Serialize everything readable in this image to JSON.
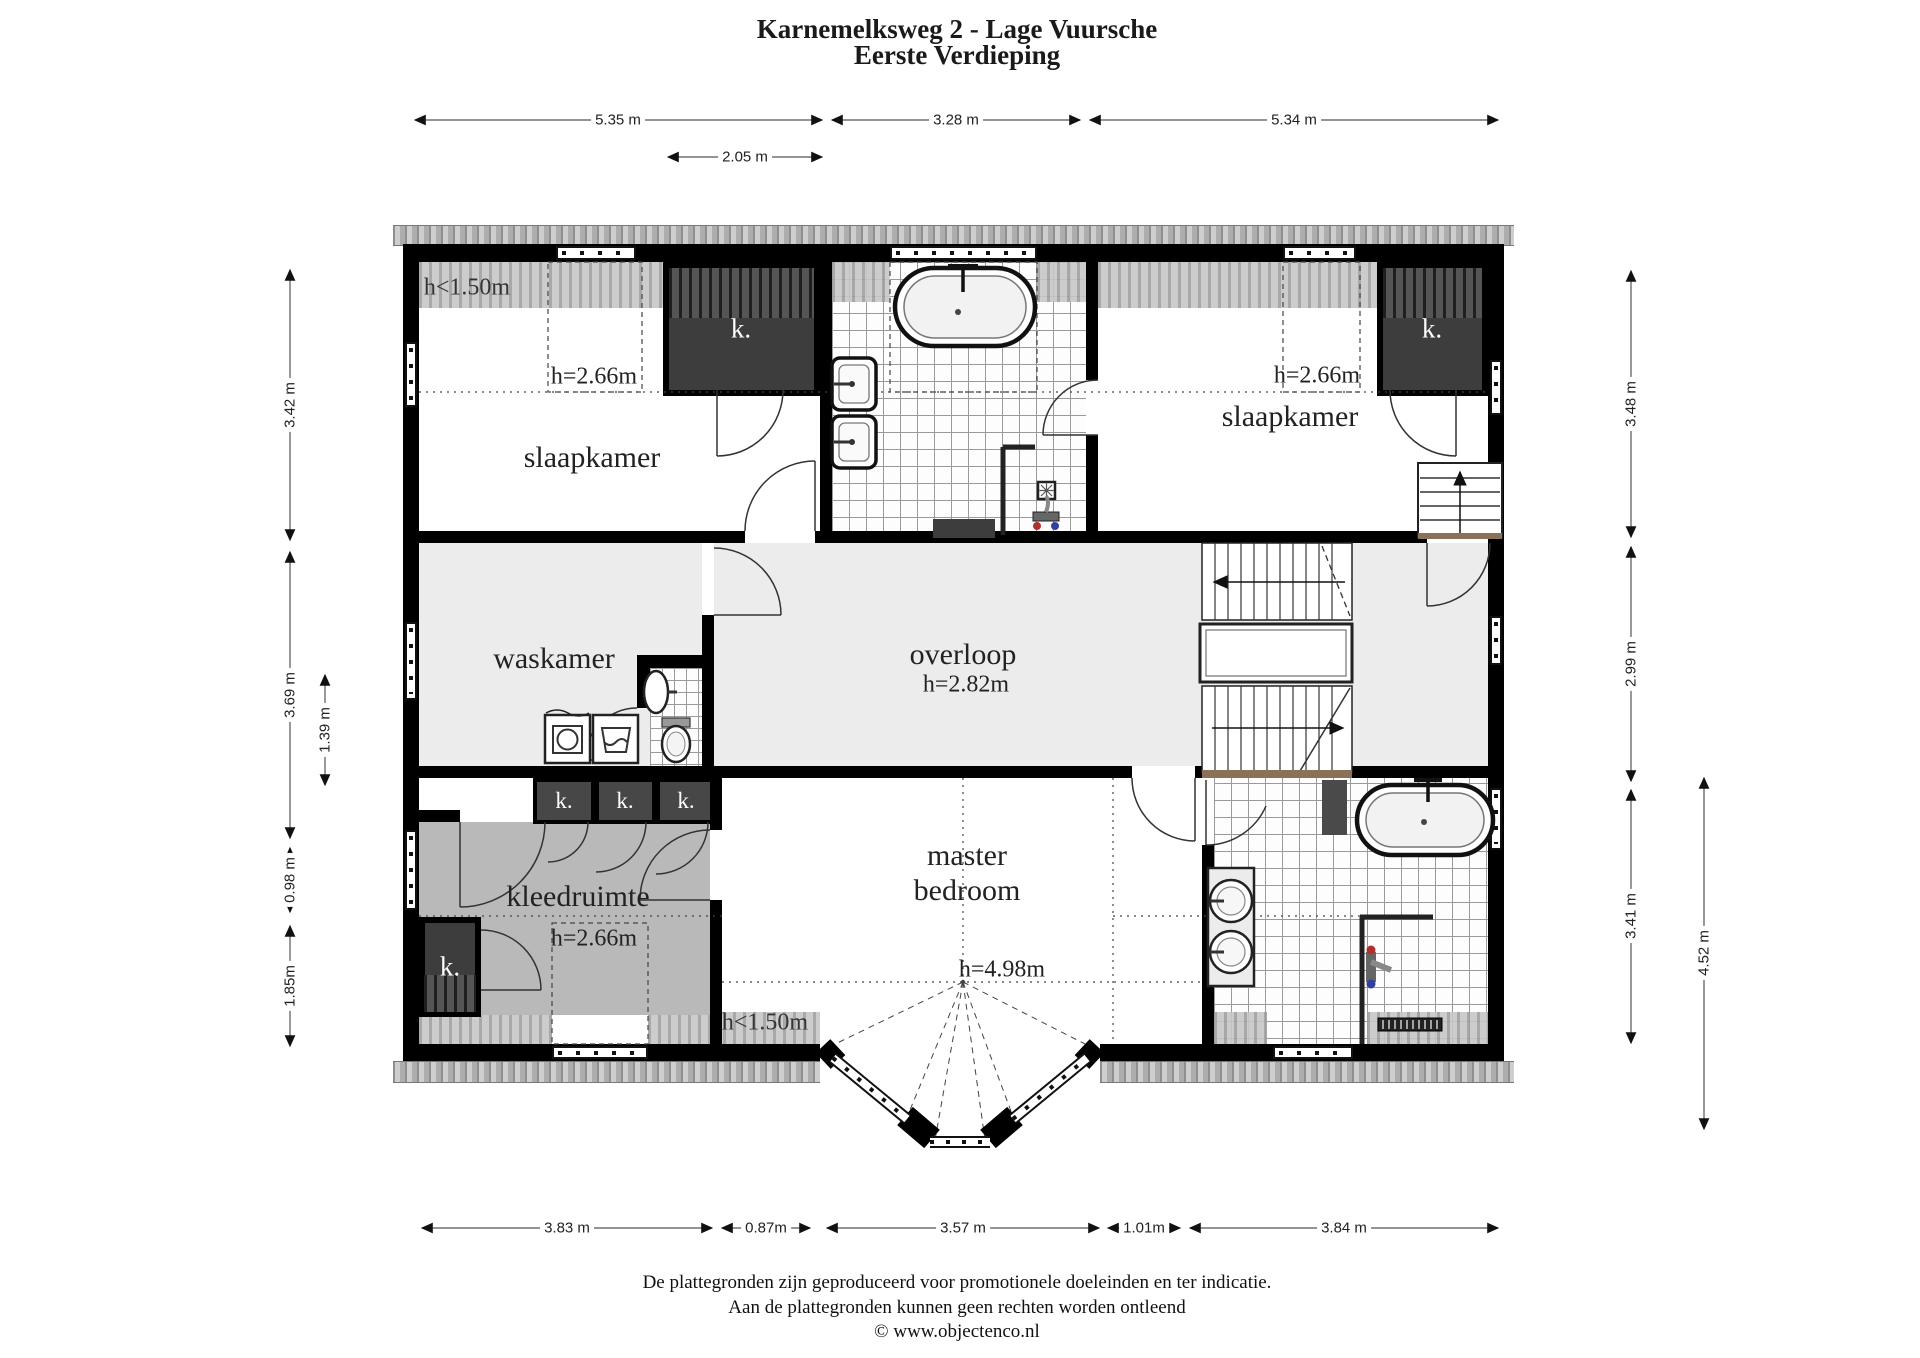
{
  "title": {
    "line1": "Karnemelksweg 2 - Lage Vuursche",
    "line2": "Eerste Verdieping"
  },
  "labels": {
    "slaapkamer_left": "slaapkamer",
    "slaapkamer_right": "slaapkamer",
    "waskamer": "waskamer",
    "overloop": "overloop",
    "overloop_height": "h=2.82m",
    "kleedruimte": "kleedruimte",
    "master_line1": "master",
    "master_line2": "bedroom",
    "master_height": "h=4.98m",
    "low_headroom": "h<1.50m",
    "dormer_height": "h=2.66m",
    "closet": "k."
  },
  "dimensions": {
    "top": [
      "5.35 m",
      "3.28 m",
      "5.34 m"
    ],
    "top_inner": "2.05 m",
    "left": [
      "3.42 m",
      "3.69 m",
      "1.39 m",
      "0.98 m",
      "1.85m"
    ],
    "right": [
      "3.48 m",
      "2.99 m",
      "3.41 m",
      "4.52 m"
    ],
    "bottom": [
      "3.83 m",
      "0.87m",
      "3.57 m",
      "1.01m",
      "3.84 m"
    ]
  },
  "footer": {
    "line1": "De plattegronden zijn geproduceerd voor promotionele doeleinden en ter indicatie.",
    "line2": "Aan de plattegronden kunnen geen rechten worden ontleend",
    "line3": "© www.objectenco.nl"
  },
  "colors": {
    "wall": "#000000",
    "floor_light": "#ececec",
    "floor_mid": "#b9b9b9",
    "closet_dark": "#3d3d3d",
    "tile_line": "#9a9a9a"
  }
}
